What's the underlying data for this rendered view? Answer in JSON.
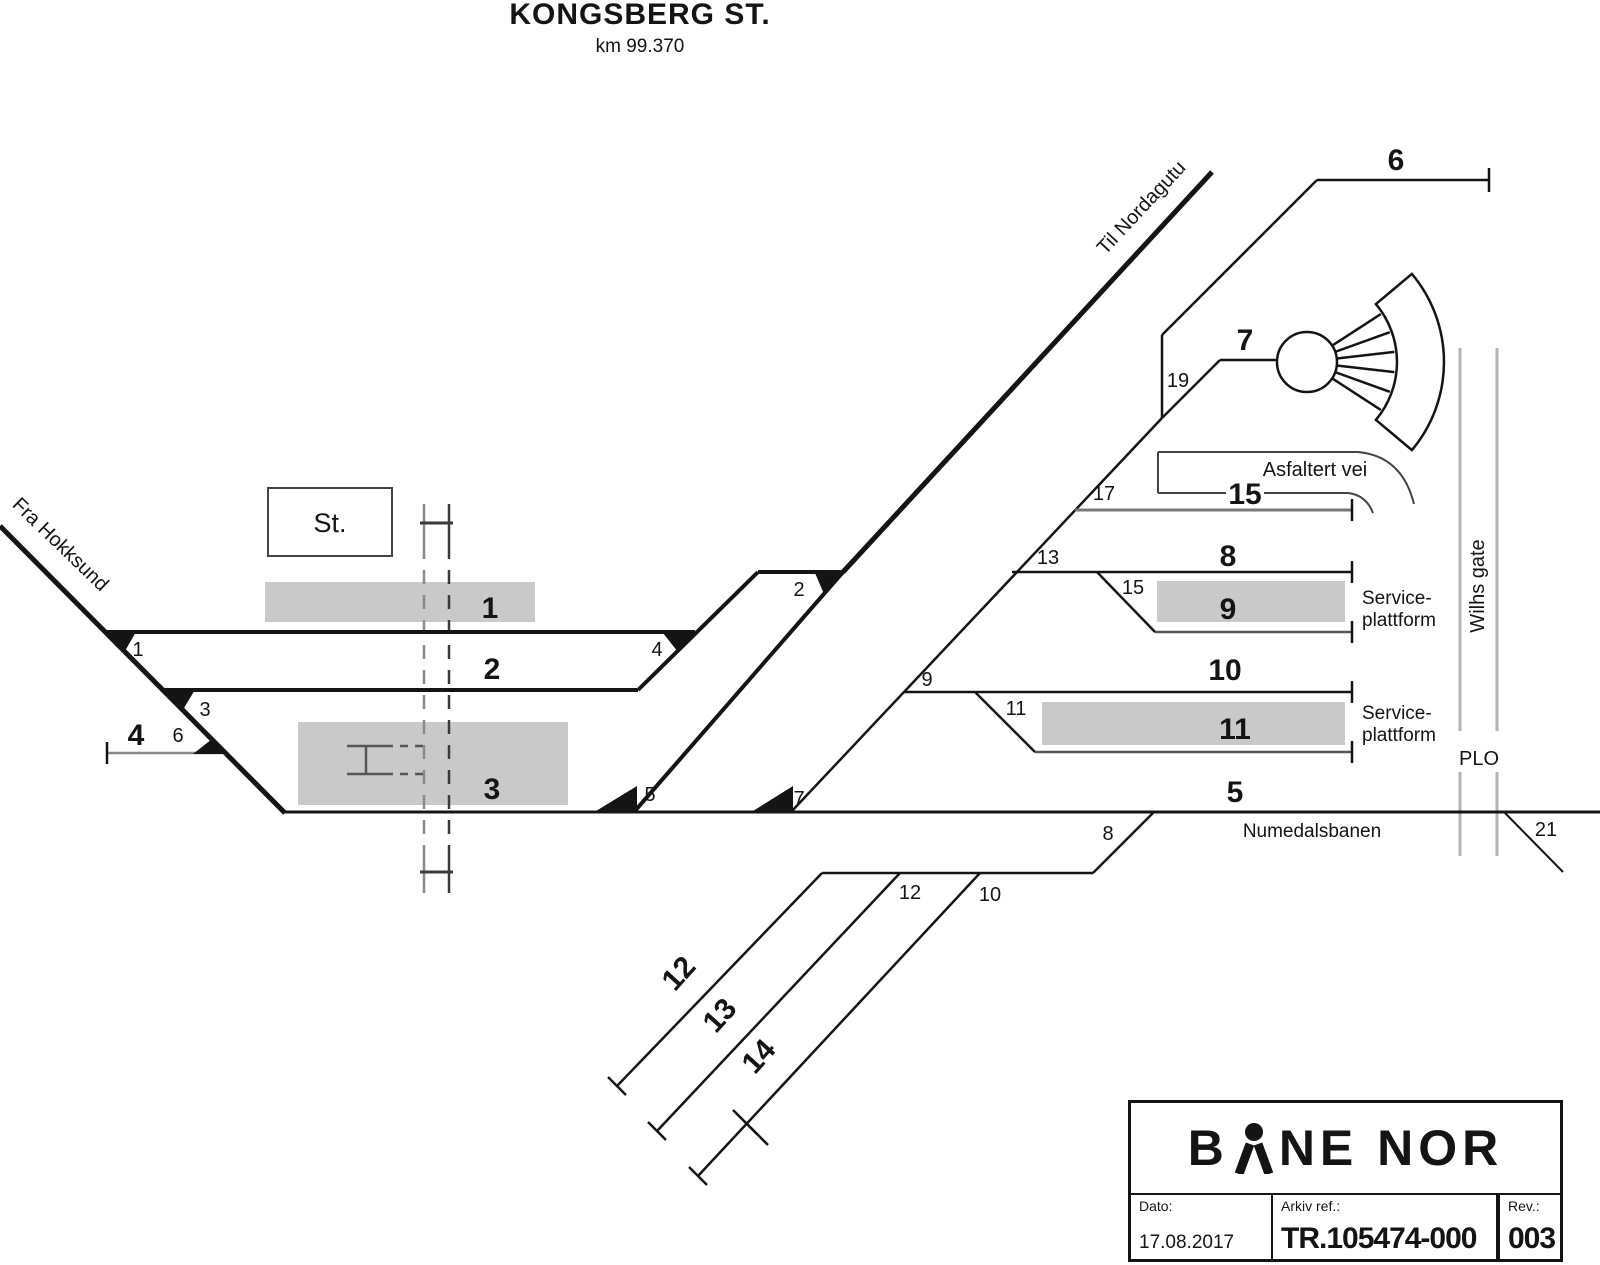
{
  "header": {
    "title": "KONGSBERG ST.",
    "km": "km 99.370"
  },
  "endpoints": {
    "from": "Fra Hokksund",
    "to": "Til Nordagutu"
  },
  "station_box": {
    "label": "St."
  },
  "track_labels": {
    "t1": "1",
    "t2": "2",
    "t3": "3",
    "t4": "4",
    "t5": "5",
    "t6": "6",
    "t7": "7",
    "t8": "8",
    "t9": "9",
    "t10": "10",
    "t11": "11",
    "t12": "12",
    "t13": "13",
    "t14": "14",
    "t15": "15"
  },
  "switch_labels": {
    "s1": "1",
    "s2": "2",
    "s3": "3",
    "s4": "4",
    "s5": "5",
    "s6": "6",
    "s7": "7",
    "s8": "8",
    "s9": "9",
    "s10": "10",
    "s11": "11",
    "s12": "12",
    "s13": "13",
    "s15": "15",
    "s17": "17",
    "s19": "19",
    "s21": "21"
  },
  "annotations": {
    "asfaltert_vei": "Asfaltert vei",
    "service_line1": "Service-",
    "service_line2": "plattform",
    "numedalsbanen": "Numedalsbanen",
    "plo": "PLO",
    "street": "Wilhs gate"
  },
  "titleblock": {
    "brand_b": "B",
    "brand_rest": "NE NOR",
    "dato_label": "Dato:",
    "dato_value": "17.08.2017",
    "arkiv_label": "Arkiv ref.:",
    "arkiv_value": "TR.105474-000",
    "rev_label": "Rev.:",
    "rev_value": "003"
  },
  "colors": {
    "line": "#141414",
    "secondary": "#555555",
    "street": "#b3b3b3",
    "platform": "#c9c9c9",
    "road_outline": "#444444"
  }
}
